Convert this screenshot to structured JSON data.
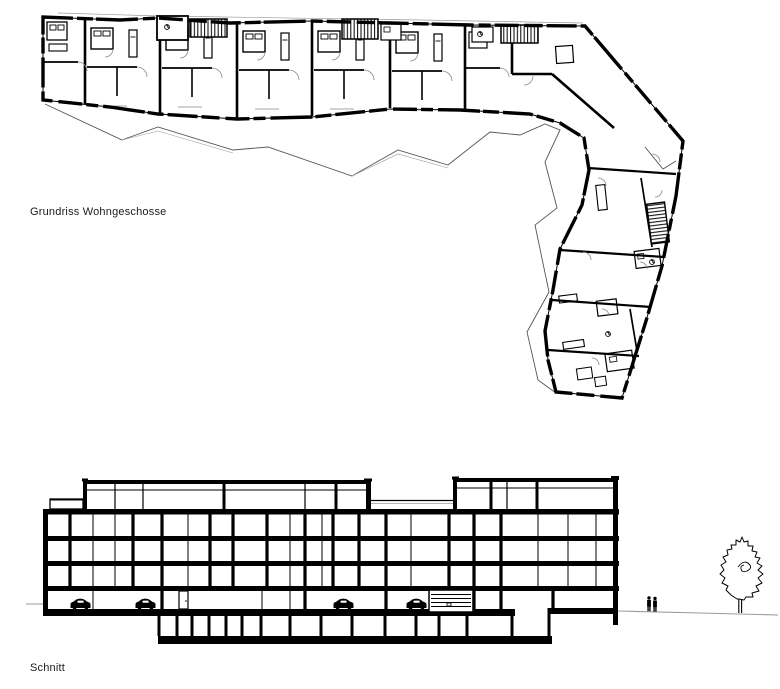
{
  "page": {
    "background_color": "#ffffff",
    "ink_color": "#000000",
    "muted_line_color": "#9a9a9a"
  },
  "drawings": {
    "plan": {
      "label": "Grundriss Wohngeschosse"
    },
    "section": {
      "label": "Schnitt"
    }
  },
  "symbols": {
    "cars_in_garage": 4,
    "people_figures": 2,
    "trees": 1,
    "stair_runs": 3
  }
}
